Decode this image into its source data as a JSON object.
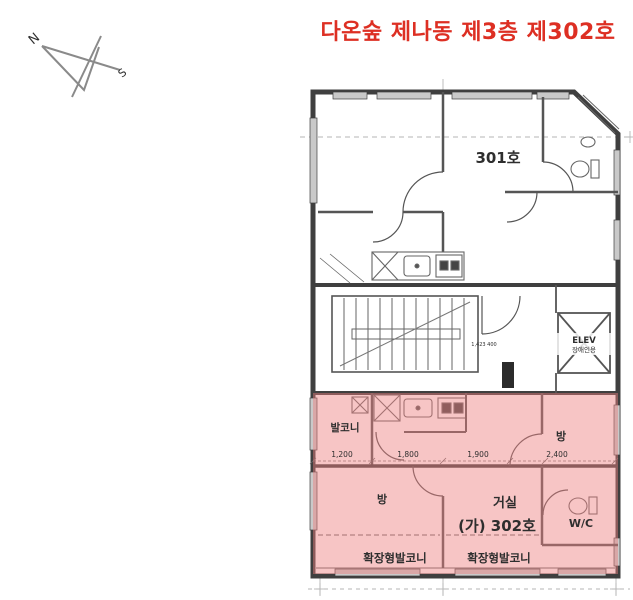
{
  "title": "다온숲 제나동 제3층 제302호",
  "compass": {
    "north": "N",
    "south": "S"
  },
  "units": {
    "u301": {
      "label": "301호"
    },
    "u302": {
      "label": "(가) 302호",
      "balcony": "발코니",
      "room_left": "방",
      "room_right": "방",
      "living": "거실",
      "wc": "W/C",
      "ext_balcony_left": "확장형발코니",
      "ext_balcony_right": "확장형발코니",
      "dims": [
        "1,200",
        "1,800",
        "1,900",
        "2,400"
      ]
    }
  },
  "core": {
    "elevator_line1": "ELEV",
    "elevator_line2": "장애인용",
    "stair_note": "1,423 400"
  },
  "colors": {
    "accent_red": "#dd2f23",
    "highlight_pink": "#ee7f7f"
  }
}
